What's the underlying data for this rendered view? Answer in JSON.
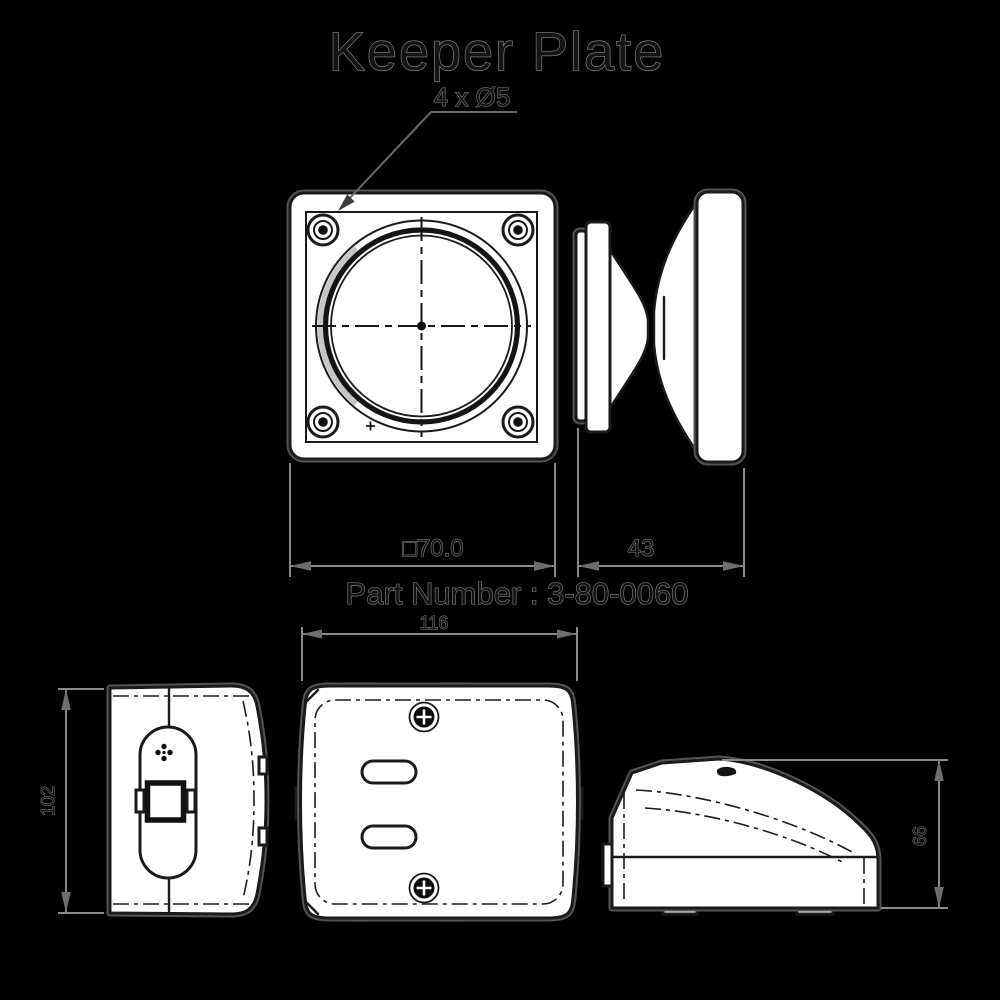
{
  "title": "Keeper Plate",
  "callout": "4 x Ø5",
  "part_number": "Part Number : 3-80-0060",
  "dimensions": {
    "plate_width": "□70.0",
    "knob_depth": "43",
    "body_width": "116",
    "body_height": "102",
    "body_side_height": "66"
  },
  "colors": {
    "background": "#000000",
    "part_fill": "#ffffff",
    "outline_ink": "#1a1a1a",
    "dimension_gray": "#8a8a8a"
  }
}
